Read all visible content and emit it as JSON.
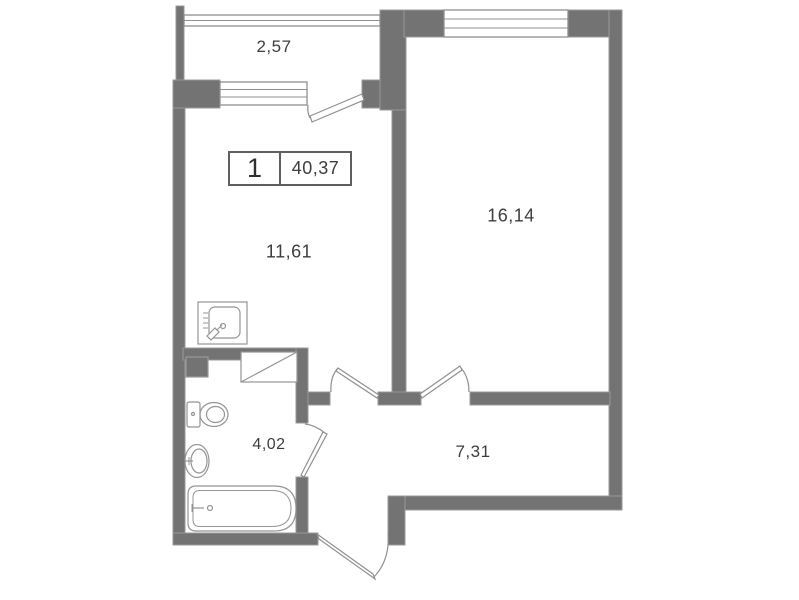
{
  "unit_card": {
    "rooms_count": "1",
    "total_area": "40,37"
  },
  "areas": {
    "balcony": "2,57",
    "kitchen_living": "11,61",
    "bedroom": "16,14",
    "bathroom": "4,02",
    "hallway": "7,31"
  },
  "colors": {
    "wall": "#737373",
    "wall_edge": "#9a9a9a",
    "line": "#8f8f8f",
    "text": "#3d3d3d",
    "bg": "#ffffff"
  },
  "fixtures": [
    "kitchen-sink",
    "toilet",
    "washbasin",
    "bathtub",
    "vent-shaft",
    "duct"
  ],
  "windows": [
    "balcony-glazing",
    "kitchen-window",
    "bedroom-window"
  ],
  "doors": [
    "balcony-door",
    "kitchen-door",
    "bedroom-door",
    "bathroom-door",
    "entrance-door"
  ]
}
